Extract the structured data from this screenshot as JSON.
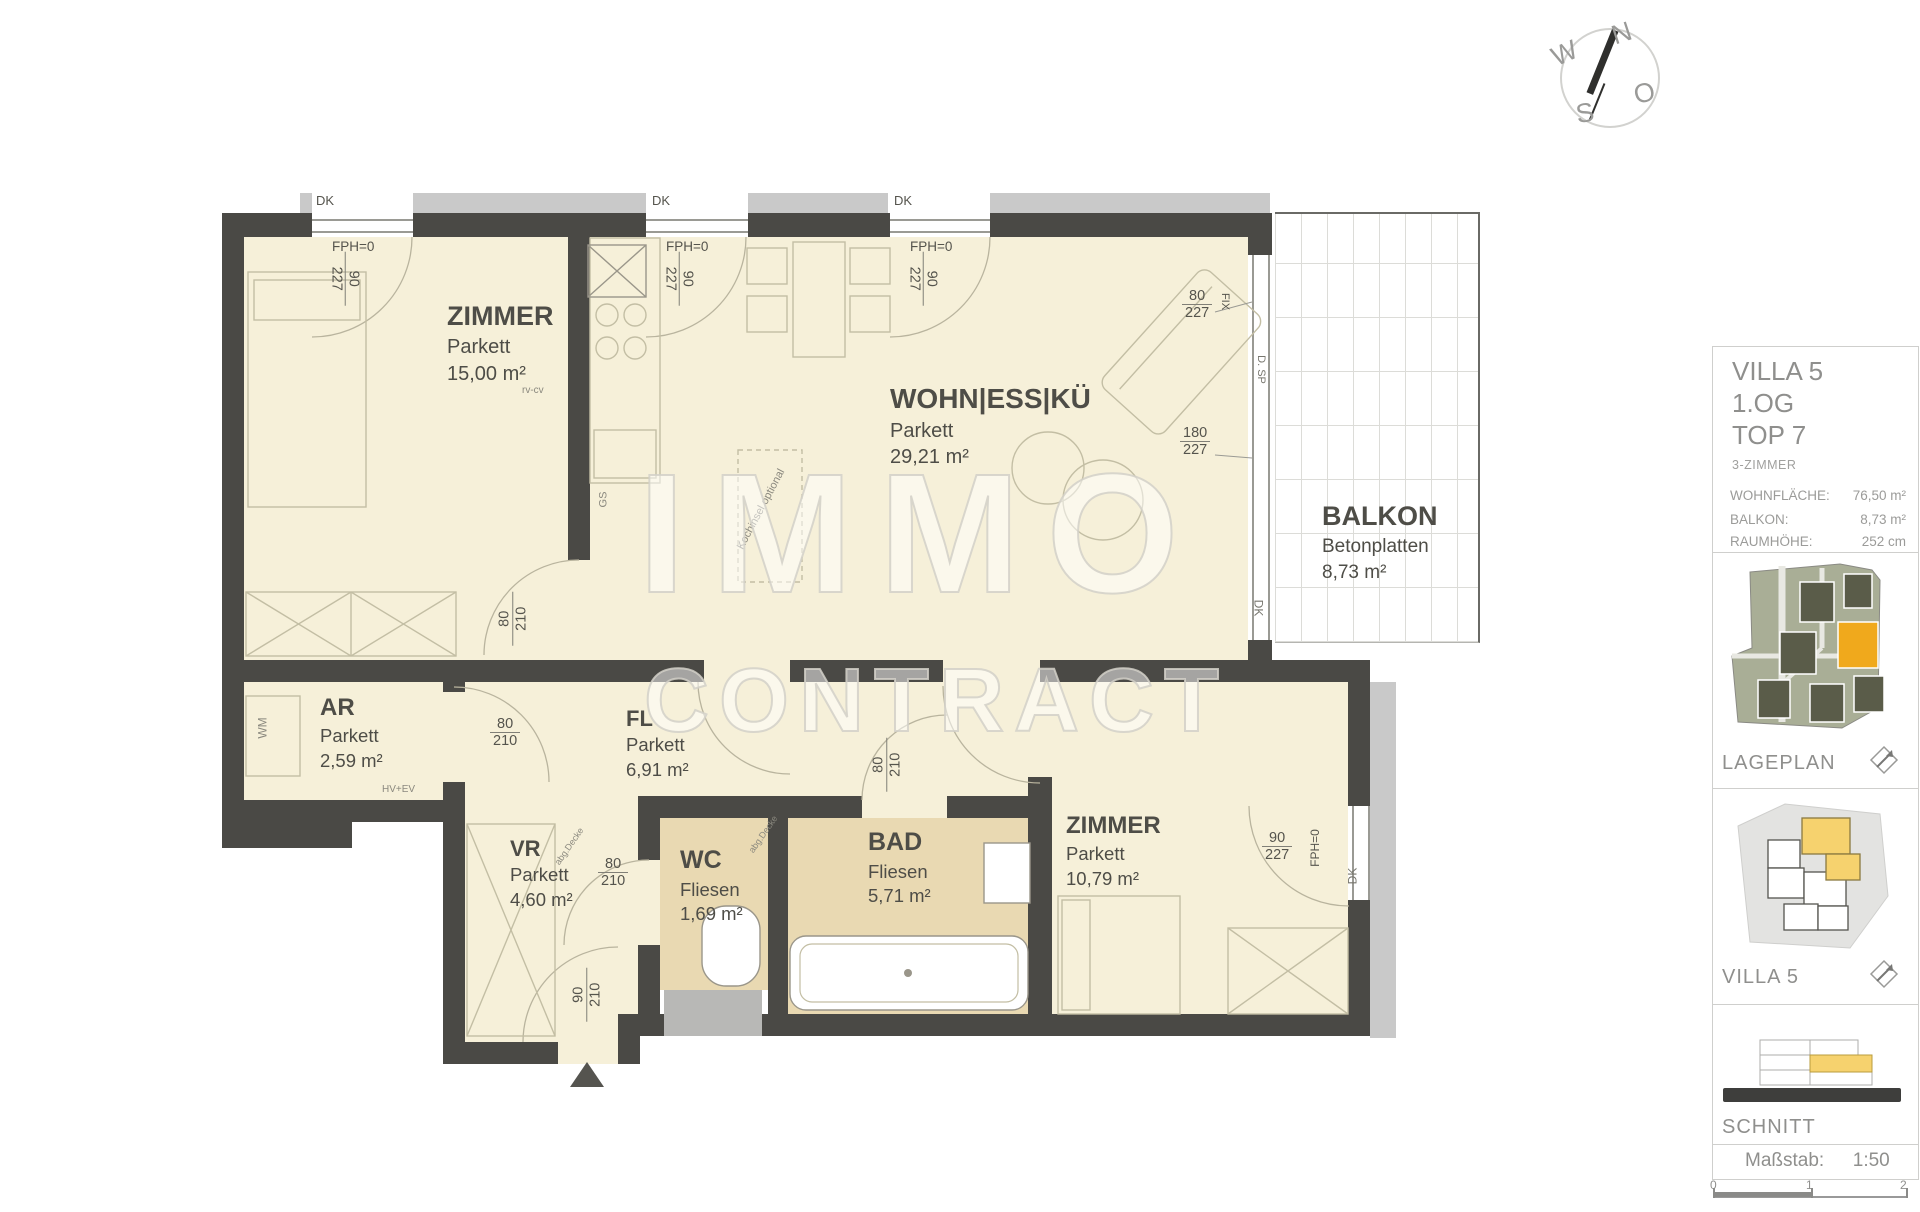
{
  "compass": {
    "n": "N",
    "w": "W",
    "s": "S",
    "o": "O"
  },
  "watermark": {
    "line1": "IMMO",
    "line2": "CONTRACT"
  },
  "rooms": {
    "zimmer1": {
      "name": "ZIMMER",
      "floor": "Parkett",
      "area": "15,00 m²"
    },
    "wohn": {
      "name": "WOHN|ESS|KÜ",
      "floor": "Parkett",
      "area": "29,21 m²"
    },
    "balkon": {
      "name": "BALKON",
      "floor": "Betonplatten",
      "area": "8,73 m²"
    },
    "ar": {
      "name": "AR",
      "floor": "Parkett",
      "area": "2,59 m²"
    },
    "fl": {
      "name": "FL",
      "floor": "Parkett",
      "area": "6,91 m²"
    },
    "vr": {
      "name": "VR",
      "floor": "Parkett",
      "area": "4,60 m²"
    },
    "wc": {
      "name": "WC",
      "floor": "Fliesen",
      "area": "1,69 m²"
    },
    "bad": {
      "name": "BAD",
      "floor": "Fliesen",
      "area": "5,71 m²"
    },
    "zimmer2": {
      "name": "ZIMMER",
      "floor": "Parkett",
      "area": "10,79 m²"
    }
  },
  "labels": {
    "dk": "DK",
    "fph": "FPH=0",
    "fix": "FIX",
    "dsp": "D. SP",
    "wm": "WM",
    "gs": "GS",
    "hvev": "HV+EV",
    "rvcv": "rv-cv",
    "kochinsel": "Kochinsel optional",
    "abgdecke": "abg.Decke",
    "d80": "80",
    "d90": "90",
    "d180": "180",
    "d210": "210",
    "d227": "227"
  },
  "sidebar": {
    "project": {
      "line1": "VILLA 5",
      "line2": "1.OG",
      "line3": "TOP 7",
      "type": "3-ZIMMER"
    },
    "stats": {
      "area_label": "WOHNFLÄCHE:",
      "area_value": "76,50 m²",
      "balcony_label": "BALKON:",
      "balcony_value": "8,73 m²",
      "height_label": "RAUMHÖHE:",
      "height_value": "252 cm"
    },
    "lageplan_caption": "LAGEPLAN",
    "villa_caption": "VILLA 5",
    "schnitt_caption": "SCHNITT",
    "scale_label": "Maßstab:",
    "scale_value": "1:50",
    "scale_ticks": [
      "0",
      "1",
      "2"
    ]
  },
  "colors": {
    "cream": "#f6f0d9",
    "tan": "#e9d9b2",
    "wall": "#4a4945",
    "accent_orange": "#f0a91c",
    "highlight_yellow": "#f6d26e"
  }
}
